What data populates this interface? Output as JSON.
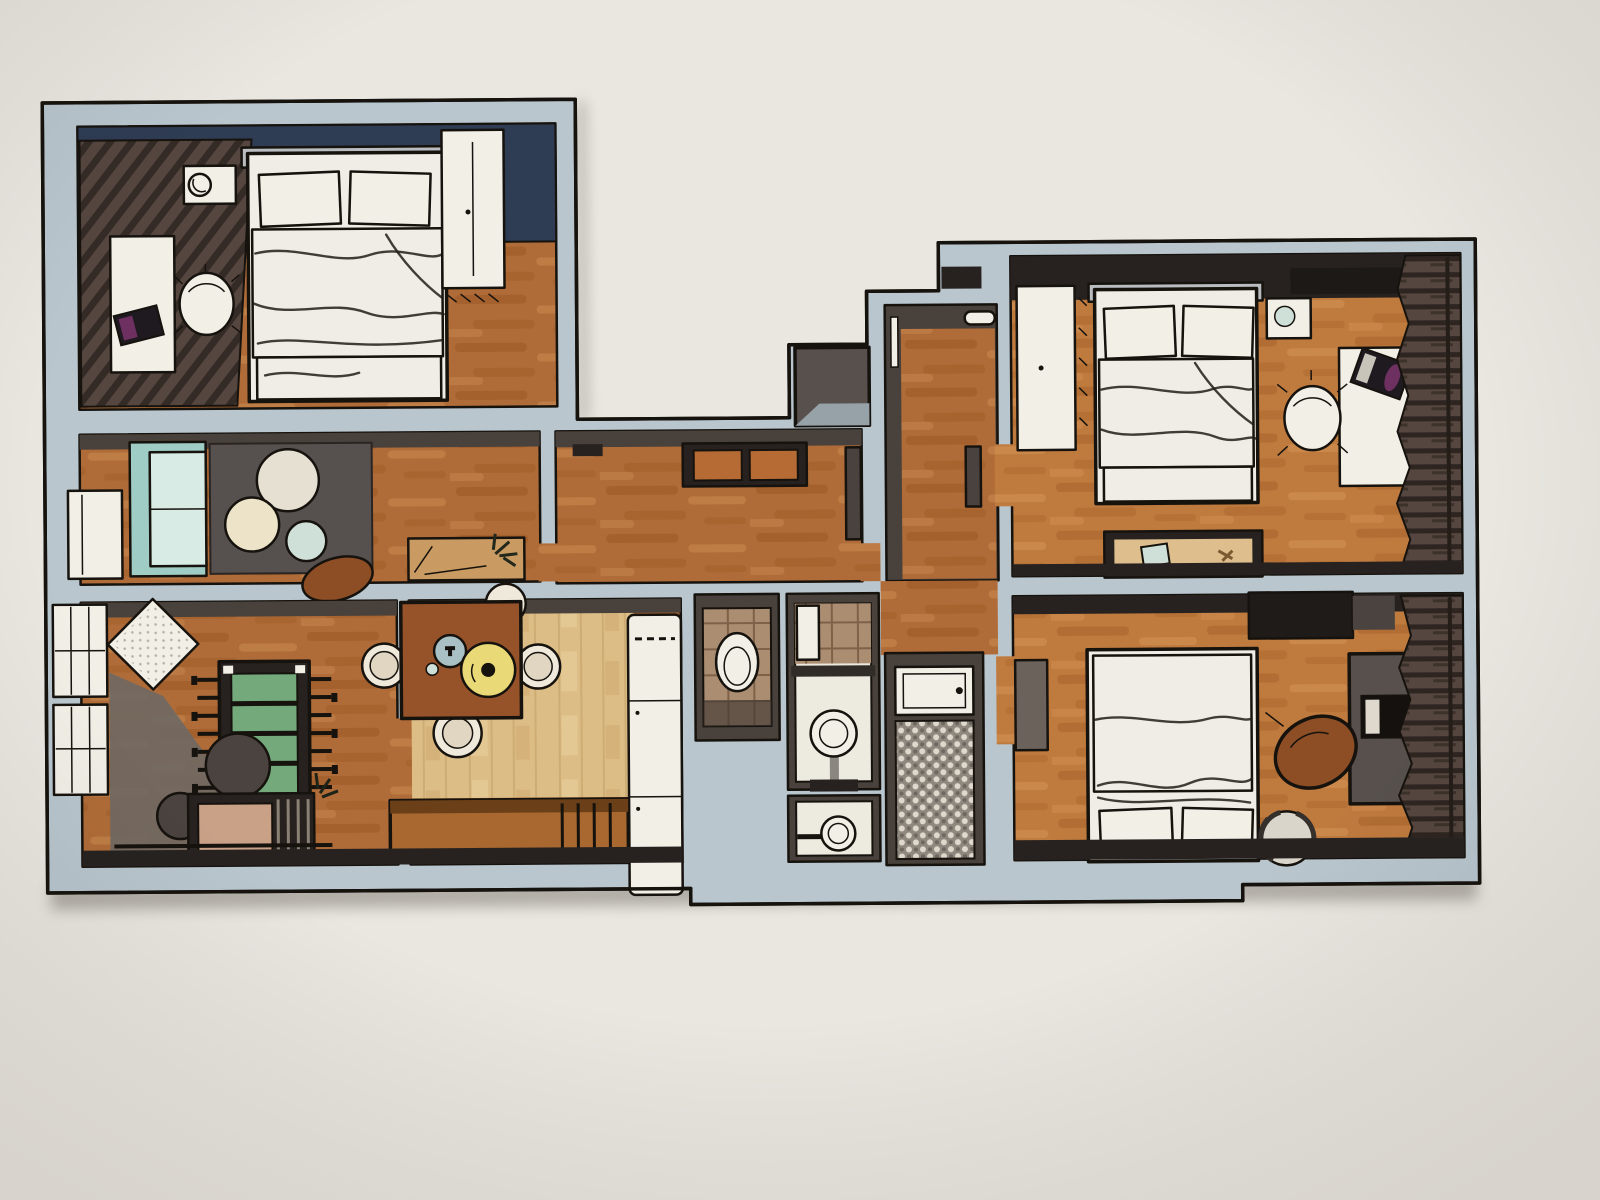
{
  "scene": {
    "kind": "3d-floor-plan-photo",
    "description": "Photograph of a 3D rendered apartment floor plan on light paper, no text labels",
    "rooms": [
      {
        "id": "bedroom-1",
        "label": "bedroom top-left",
        "furniture": [
          "double-bed",
          "wardrobe",
          "desk",
          "office-chair",
          "laptop",
          "nightstand-with-lamp",
          "window-curtain-wall",
          "navy-accent-wall"
        ]
      },
      {
        "id": "lounge",
        "label": "sitting room",
        "furniture": [
          "teal-sofa",
          "dark-rug",
          "round-coffee-table-large",
          "round-coffee-table-beige",
          "round-coffee-table-teal",
          "brown-pouf",
          "console-with-plant",
          "low-window"
        ]
      },
      {
        "id": "games-room",
        "label": "living games room",
        "furniture": [
          "tall-windows",
          "floor-cushion",
          "foosball-table",
          "round-table-large",
          "round-table-small",
          "sideboard-with-books",
          "plant"
        ]
      },
      {
        "id": "dining-kitchen",
        "label": "kitchen and dining",
        "furniture": [
          "dining-table",
          "chair-left",
          "chair-right",
          "chair-bottom",
          "chair-top",
          "yellow-tray",
          "blue-plate",
          "kitchen-counter",
          "wood-bench"
        ]
      },
      {
        "id": "hallway",
        "label": "corridor",
        "furniture": [
          "console-bench",
          "open-door"
        ]
      },
      {
        "id": "entry",
        "label": "entrance hall",
        "furniture": [
          "front-door",
          "storage-box"
        ]
      },
      {
        "id": "wc",
        "label": "toilet room",
        "furniture": [
          "toilet",
          "tile-floor"
        ]
      },
      {
        "id": "bathroom",
        "label": "bathroom",
        "furniture": [
          "pedestal-sink",
          "tiled-wall",
          "door",
          "shelf"
        ]
      },
      {
        "id": "washroom",
        "label": "small washroom",
        "furniture": [
          "wall-sink"
        ]
      },
      {
        "id": "shower-room",
        "label": "shower room",
        "furniture": [
          "basin",
          "mosaic-floor"
        ]
      },
      {
        "id": "bedroom-2",
        "label": "bedroom top-right",
        "furniture": [
          "double-bed",
          "wardrobe",
          "nightstand",
          "desk",
          "office-chair",
          "laptop",
          "low-dresser",
          "wall-shelf",
          "window-curtains"
        ]
      },
      {
        "id": "bedroom-3",
        "label": "bedroom bottom-right",
        "furniture": [
          "double-bed",
          "dark-wardrobe",
          "desk",
          "laptop",
          "leather-office-chair",
          "striped-pouf",
          "open-door",
          "window-curtains"
        ]
      }
    ]
  },
  "colors": {
    "paper": "#eae7e1",
    "line": "#16120d",
    "wall": "#b9c6ce",
    "face-dark": "#49413b",
    "face-black": "#272220",
    "navy": "#2e3c54",
    "wood": "#b06c38",
    "wood-dark": "#96551f",
    "wood-streak": "#cb8d52",
    "wood-orange": "#bf7a3e",
    "wood-orange-dark": "#a05d25",
    "wood-orange-streak": "#d89657",
    "wood-pale": "#dcbd86",
    "wood-pale-line": "#c2a066",
    "rug": "#56514e",
    "sofa": "#9fcdc5",
    "sofa-seat": "#d8ebe5",
    "table-cream": "#e5e0d1",
    "table-beige": "#ece3c8",
    "table-teal": "#cfe0d8",
    "felt-green": "#74a97c",
    "dining-wood": "#96532a",
    "tray-yellow": "#ead977",
    "plate-blue": "#a9c0c5",
    "chair-beige": "#efe9db",
    "chair-seat": "#e0d6c2",
    "white": "#f2efe7",
    "bench-wood": "#a8682f",
    "bench-top": "#6b4018",
    "tile": "#ab8d72",
    "tile-line": "#7e6148",
    "bath-floor": "#edeae0",
    "mosaic": "#8e887f",
    "mosaic-dot": "#ded9cc",
    "bed": "#efede6",
    "headboard": "#b9bdc0",
    "laptop": "#1e1a20",
    "laptop-screen": "#6e3060",
    "curtain": "#55463f",
    "curtain-stripe": "#241d18",
    "shadow-gray": "#6f6964",
    "chair-brown": "#8d4e26",
    "desk-gray": "#57504c",
    "pouf": "#d9d5ca",
    "console-tan": "#c99a62",
    "sideboard-top": "#c9a187",
    "dresser-top": "#ddbe8c",
    "bench-orange": "#b56b33",
    "door-leaf": "#4a423e"
  }
}
